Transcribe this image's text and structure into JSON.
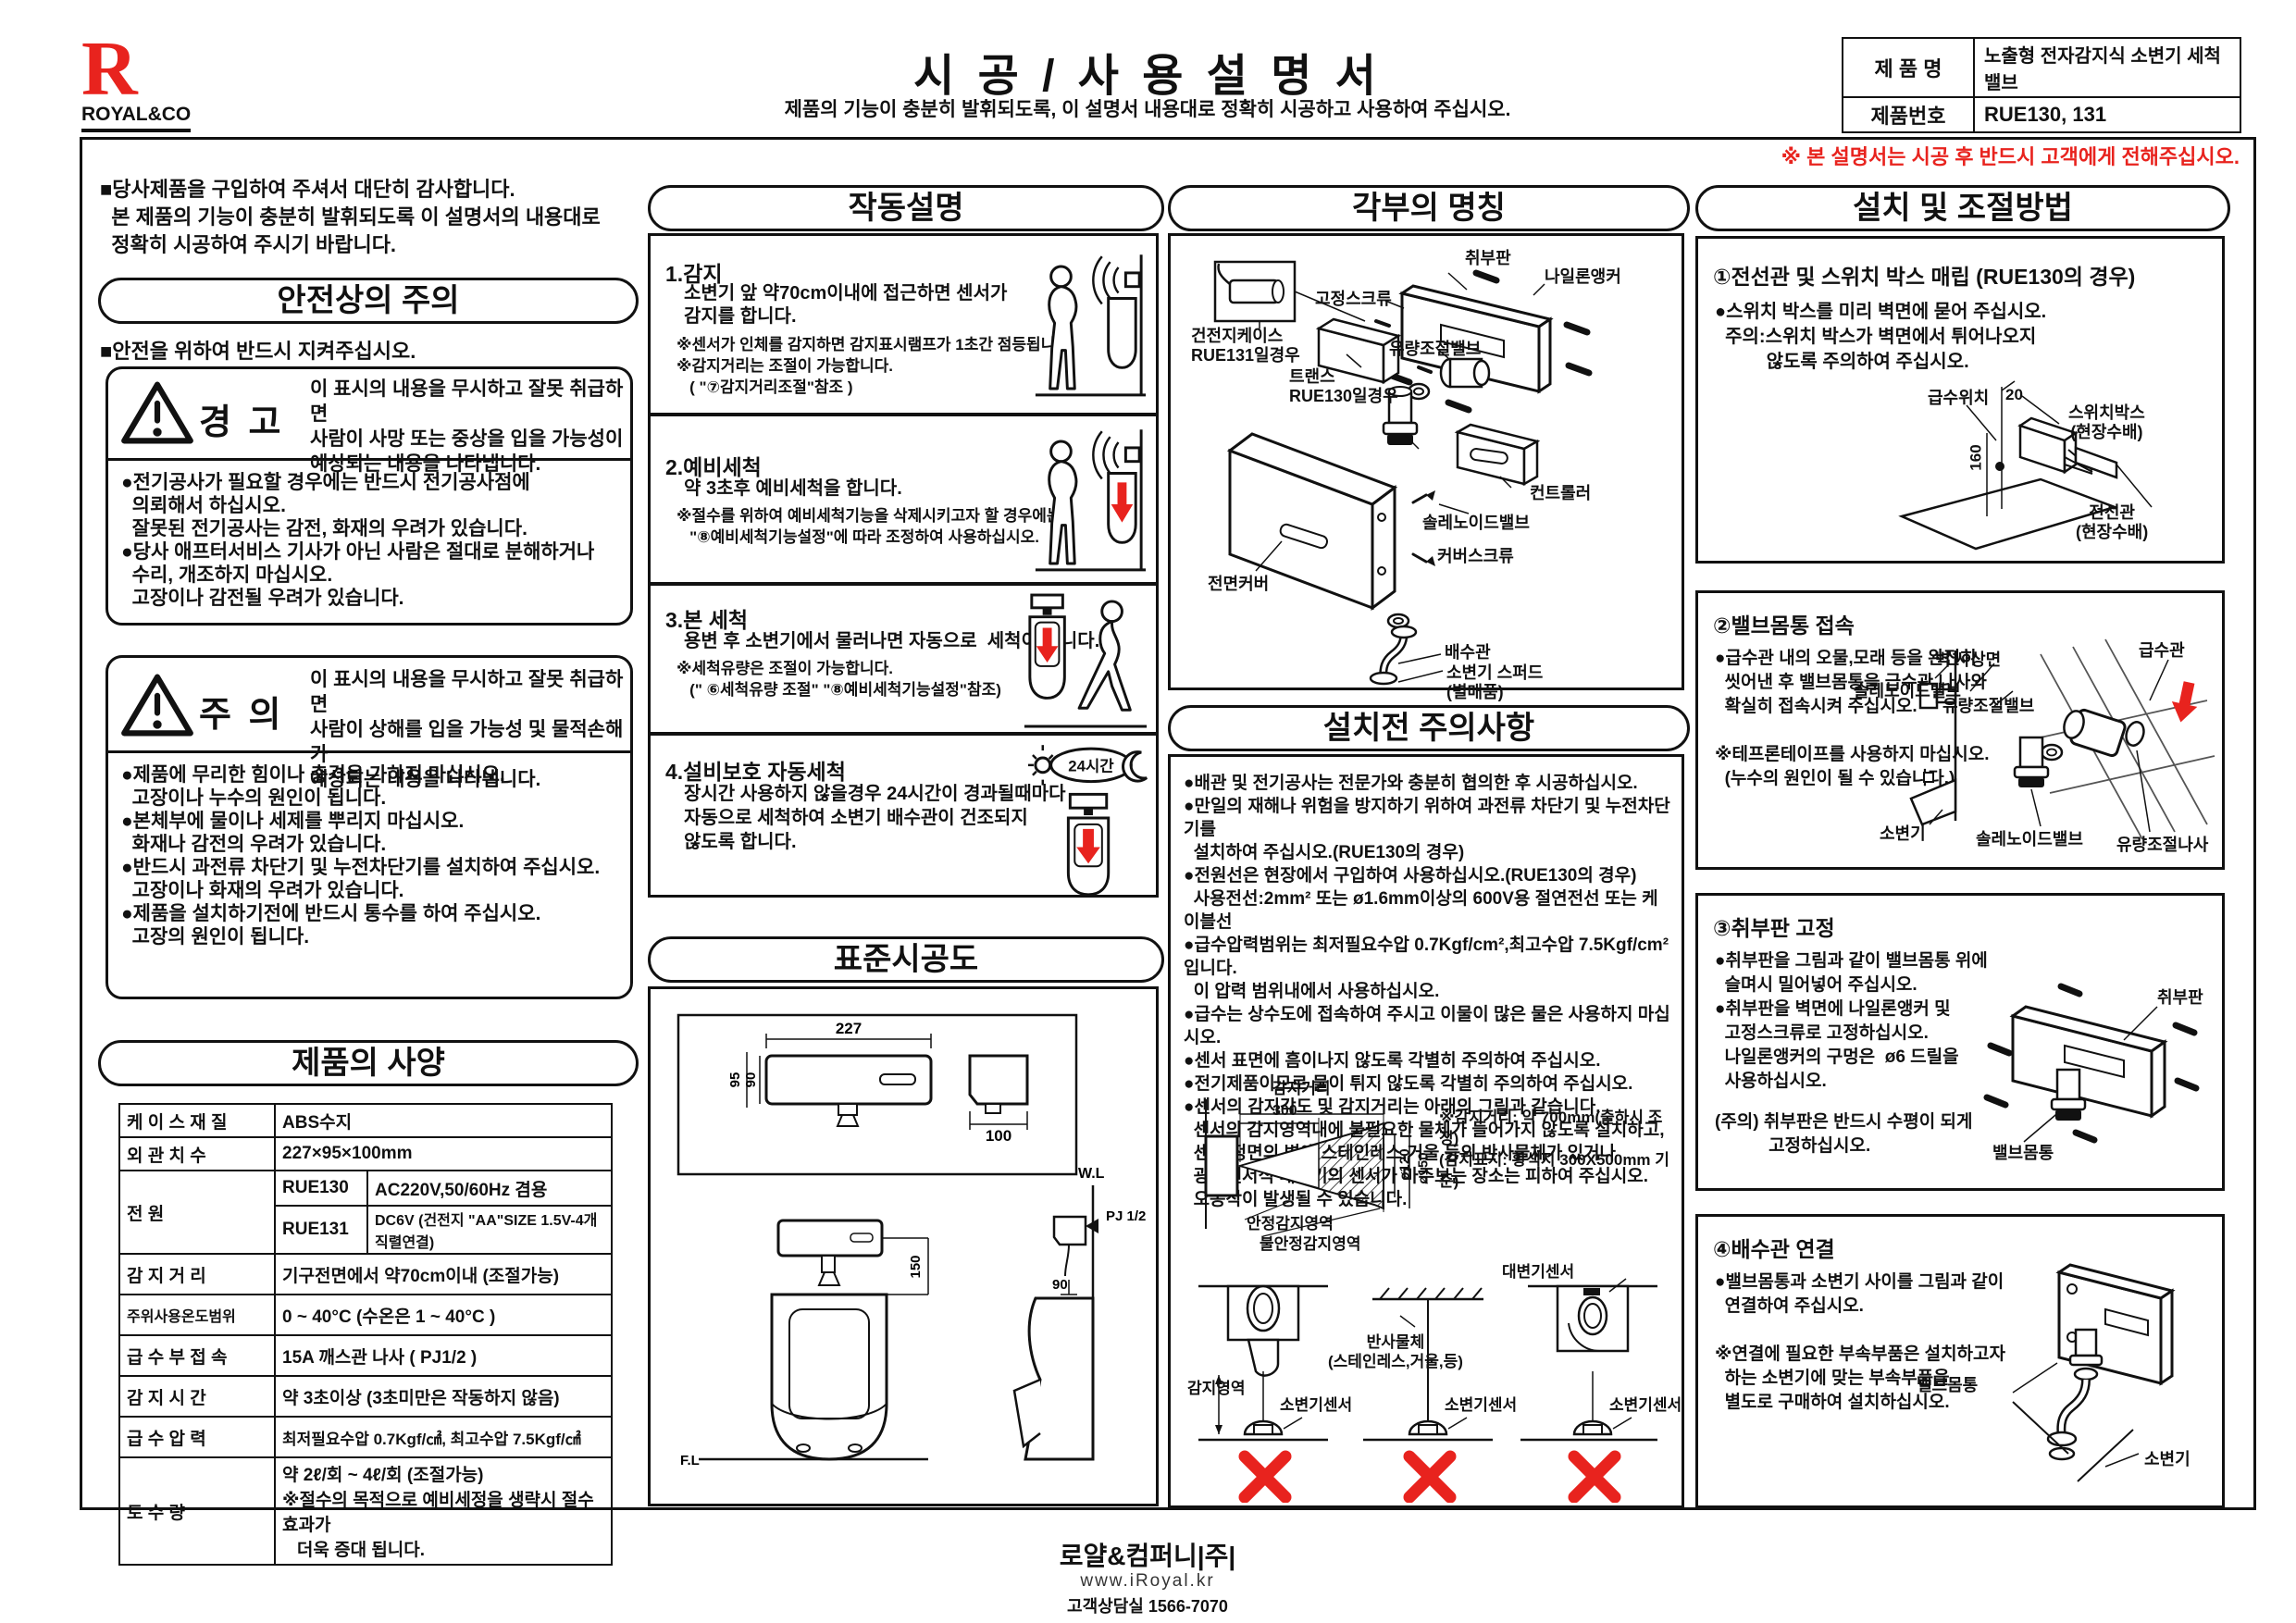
{
  "colors": {
    "accent_red": "#e8231e",
    "ink": "#111111"
  },
  "header": {
    "logo_letter": "R",
    "logo_name": "ROYAL&CO",
    "title": "시 공 / 사 용 설 명 서",
    "subtitle": "제품의 기능이 충분히 발휘되도록, 이 설명서 내용대로 정확히 시공하고 사용하여 주십시오.",
    "product_name_label": "제 품 명",
    "product_name_value": "노출형 전자감지식 소변기 세척밸브",
    "product_no_label": "제품번호",
    "product_no_value": "RUE130, 131",
    "handover_note": "※ 본 설명서는 시공 후 반드시 고객에게 전해주십시오."
  },
  "intro": {
    "text": "■당사제품을 구입하여 주셔서 대단히 감사합니다.\n  본 제품의 기능이 충분히 발휘되도록 이 설명서의 내용대로\n  정확히 시공하여 주시기 바랍니다."
  },
  "safety": {
    "title": "안전상의 주의",
    "keep_note": "■안전을 위하여 반드시 지켜주십시오.",
    "warning_label": "경 고",
    "warning_desc": "이 표시의 내용을 무시하고 잘못 취급하면\n사람이 사망 또는 중상을 입을 가능성이\n예상되는 내용을 나타냅니다.",
    "warning_items": "●전기공사가 필요할 경우에는 반드시 전기공사점에\n  의뢰해서 하십시오.\n  잘못된 전기공사는 감전, 화재의 우려가 있습니다.\n●당사 애프터서비스 기사가 아닌 사람은 절대로 분해하거나\n  수리, 개조하지 마십시오.\n  고장이나 감전될 우려가 있습니다.",
    "caution_label": "주 의",
    "caution_desc": "이 표시의 내용을 무시하고 잘못 취급하면\n사람이 상해를 입을 가능성 및 물적손해가\n예상되는 내용을 나타냅니다.",
    "caution_items": "●제품에 무리한 힘이나 충격을 가하지 마십시오.\n  고장이나 누수의 원인이 됩니다.\n●본체부에 물이나 세제를 뿌리지 마십시오.\n  화재나 감전의 우려가 있습니다.\n●반드시 과전류 차단기 및 누전차단기를 설치하여 주십시오.\n  고장이나 화재의 우려가 있습니다.\n●제품을 설치하기전에 반드시 통수를 하여 주십시오.\n  고장의 원인이 됩니다."
  },
  "spec": {
    "title": "제품의 사양",
    "rows": {
      "case_label": "케 이 스 재 질",
      "case_value": "ABS수지",
      "size_label": "외 관 치 수",
      "size_value": "227×95×100mm",
      "power_label": "전             원",
      "power_m1": "RUE130",
      "power_v1": "AC220V,50/60Hz 겸용",
      "power_m2": "RUE131",
      "power_v2": "DC6V (건전지 \"AA\"SIZE 1.5V-4개 직렬연결)",
      "range_label": "감 지 거 리",
      "range_value": "기구전면에서 약70cm이내 (조절가능)",
      "temp_label": "주위사용온도범위",
      "temp_value": "0 ~ 40°C (수온은 1 ~ 40°C )",
      "supply_label": "급 수 부 접 속",
      "supply_value": "15A 깨스관 나사 ( PJ1/2 )",
      "time_label": "감 지 시 간",
      "time_value": "약 3초이상 (3초미만은 작동하지 않음)",
      "pressure_label": "급 수 압 력",
      "pressure_value": "최저필요수압 0.7Kgf/㎠,  최고수압 7.5Kgf/㎠",
      "flow_label": "토    수    량",
      "flow_value": "약 2ℓ/회 ~ 4ℓ/회 (조절가능)\n※절수의 목적으로 예비세정을 생략시 절수효과가\n   더욱 증대 됩니다."
    }
  },
  "operation": {
    "title": "작동설명",
    "steps": [
      {
        "title": "1.감지",
        "body": "소변기 앞 약70cm이내에 접근하면 센서가\n감지를 합니다.",
        "note": "※센서가 인체를 감지하면 감지표시램프가 1초간 점등됩니다.\n※감지거리는 조절이 가능합니다.\n   ( \"⑦감지거리조절\"참조 )"
      },
      {
        "title": "2.예비세척",
        "body": "약 3초후 예비세척을 합니다.",
        "note": "※절수를 위하여 예비세척기능을 삭제시키고자 할 경우에는\n   \"⑧예비세척기능설정\"에 따라 조정하여 사용하십시오."
      },
      {
        "title": "3.본 세척",
        "body": "용변 후 소변기에서 물러나면 자동으로  세척이 됩니다.",
        "note": "※세척유량은 조절이 가능합니다.\n   (\" ⑥세척유량 조절\" \"⑧예비세척기능설정\"참조)"
      },
      {
        "title": "4.설비보호 자동세척",
        "body": "장시간 사용하지 않을경우 24시간이 경과될때마다\n자동으로 세척하여 소변기 배수관이 건조되지\n않도록 합니다.",
        "icon_label": "24시간"
      }
    ]
  },
  "standard": {
    "title": "표준시공도",
    "dims": {
      "w227": "227",
      "h95": "95",
      "h90": "90",
      "d100": "100",
      "h150": "150",
      "h90b": "90",
      "wl": "W.L",
      "fl": "F.L",
      "pj": "PJ 1/2"
    }
  },
  "parts": {
    "title": "각부의 명칭",
    "labels": [
      "취부판",
      "나일론앵커",
      "고정스크류",
      "건전지케이스\nRUE131일경우",
      "트랜스\nRUE130일경우",
      "유량조절밸브",
      "컨트롤러",
      "솔레노이드밸브",
      "커버스크류",
      "전면커버",
      "배수관",
      "소변기 스퍼드\n(별매품)"
    ]
  },
  "precautions": {
    "title": "설치전 주의사항",
    "items": "●배관 및 전기공사는 전문가와 충분히 협의한 후 시공하십시오.\n●만일의 재해나 위험을 방지하기 위하여 과전류 차단기 및 누전차단기를\n  설치하여 주십시오.(RUE130의 경우)\n●전원선은 현장에서 구입하여 사용하십시오.(RUE130의 경우)\n  사용전선:2mm² 또는 ø1.6mm이상의 600V용 절연전선 또는 케이블선\n●급수압력범위는 최저필요수압 0.7Kgf/cm²,최고수압 7.5Kgf/cm² 입니다.\n  이 압력 범위내에서 사용하십시오.\n●급수는 상수도에 접속하여 주시고 이물이 많은 물은 사용하지 마십시오.\n●센서 표면에 흠이나지 않도록 각별히 주의하여 주십시오.\n●전기제품이므로 물이 튀지 않도록 각별히 주의하여 주십시오.\n●센서의 감지각도 및 감지거리는 아래의 그림과 같습니다.\n  센서의 감지영역내에 불필요한 물체가 들어가지 않도록 설치하고,\n  센서 정면의 벽에 스테인레스,거울 등의 반사물체가 있거나\n  광전센서식 대변기의 센서가 마주보는 장소는 피하여 주십시오.\n  오동작이 발생될 수 있습니다.",
    "sensor": {
      "dist_label": "감지거리",
      "d300": "300",
      "d120": "ø120",
      "d150": "ø150",
      "stable": "안정감지영역",
      "unstable": "불안정감지영역",
      "note": "※감지거리: 약 700mm(출하시 조정)\n(감지표지: 황색지 300X500mm 기준)"
    },
    "avoid": {
      "area": "감지영역",
      "sensor1": "소변기센서",
      "reflect": "반사물체\n(스테인레스,거울,등)",
      "sensor2": "소변기센서",
      "toilet_sensor": "대변기센서",
      "sensor3": "소변기센서"
    }
  },
  "install": {
    "title": "설치 및 조절방법",
    "sec1": {
      "heading": "①전선관 및 스위치 박스 매립 (RUE130의 경우)",
      "body": "●스위치 박스를 미리 벽면에 묻어 주십시오.\n  주의:스위치 박스가 벽면에서 튀어나오지\n          않도록 주의하여 주십시오.",
      "labels": {
        "supply": "급수위치",
        "d20": "20",
        "d160": "160",
        "switchbox": "스위치박스\n(현장수배)",
        "conduit": "전선관\n(현장수배)"
      }
    },
    "sec2": {
      "heading": "②밸브몸통 접속",
      "body": "●급수관 내의 오물,모래 등을 완전히\n  씻어낸 후 밸브몸통을 급수관 나사와\n  확실히 접속시켜 주십시오.\n\n※테프론테이프를 사용하지 마십시오.\n  (누수의 원인이 될 수 있습니다.)",
      "labels": {
        "pipe": "급수관",
        "wall": "벽 사상면",
        "solenoid1": "솔레노이드밸브",
        "flowvalve": "유량조절밸브",
        "urinal": "소변기",
        "solenoid2": "솔레노이드밸브",
        "flowscrew": "유량조절나사"
      }
    },
    "sec3": {
      "heading": "③취부판 고정",
      "body": "●취부판을 그림과 같이 밸브몸통 위에\n  슬며시 밀어넣어 주십시오.\n●취부판을 벽면에 나일론앵커 및\n  고정스크류로 고정하십시오.\n  나일론앵커의 구멍은  ø6 드릴을\n  사용하십시오.",
      "note": "(주의) 취부판은 반드시 수평이 되게\n           고정하십시오.",
      "labels": {
        "plate": "취부판",
        "valvebody": "밸브몸통"
      }
    },
    "sec4": {
      "heading": "④배수관 연결",
      "body": "●밸브몸통과 소변기 사이를 그림과 같이\n  연결하여 주십시오.\n\n※연결에 필요한 부속부품은 설치하고자\n  하는 소변기에 맞는 부속부품을\n  별도로 구매하여 설치하십시오.",
      "labels": {
        "valvebody": "밸브몸통",
        "urinal": "소변기"
      }
    }
  },
  "footer": {
    "company": "로얄&컴퍼니|주|",
    "website": "www.iRoyal.kr",
    "phone": "고객상담실 1566-7070"
  }
}
